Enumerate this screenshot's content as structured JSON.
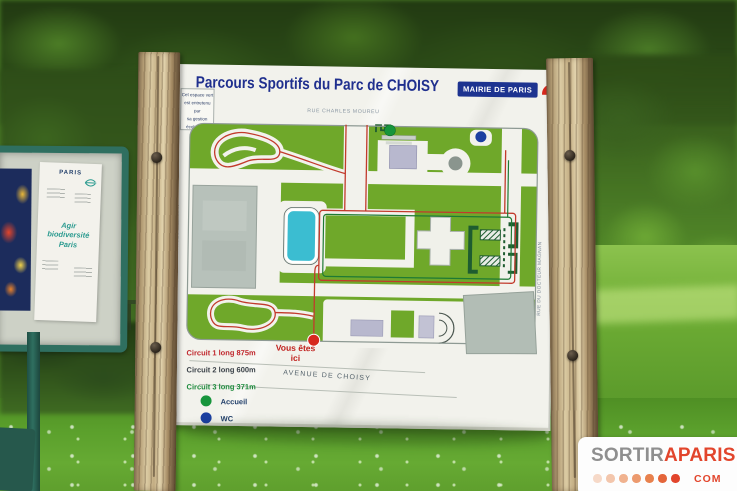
{
  "photo": {
    "subject": "Park sports-circuit information sign, Parc de Choisy, Paris"
  },
  "sign": {
    "title": "Parcours Sportifs du Parc de CHOISY",
    "badge": {
      "label": "MAIRIE DE PARIS"
    },
    "eco_label": {
      "line1": "Cet espace vert",
      "line2": "est entretenu par",
      "line3": "sa gestion",
      "line4": "écologique"
    },
    "map": {
      "street_top": "RUE CHARLES MOUREU",
      "street_left": "RUE GEORGES EASTMAN",
      "street_right": "RUE DU DOCTEUR MAGNAN",
      "street_bottom": "AVENUE DE CHOISY",
      "you_are_here": "Vous êtes ici"
    },
    "legend": {
      "circuit1": "Circuit 1 long 875m",
      "circuit2": "Circuit 2 long 600m",
      "circuit3": "Circuit 3 long 371m",
      "accueil": "Accueil",
      "wc": "WC"
    }
  },
  "notice_board": {
    "brand": "PARIS",
    "line1": "Agir",
    "line2": "biodiversité",
    "line3": "Paris"
  },
  "watermark": {
    "part1": "SORTIR",
    "part2": "APARIS",
    "suffix": "COM"
  },
  "colors": {
    "map_green": "#6fa82a",
    "pond_teal": "#3bbdd1",
    "circuit_red": "#c23a2c",
    "circuit_green": "#1e7a34",
    "accueil_green": "#17953c",
    "wc_blue": "#1b3fa0",
    "you_are_here_red": "#d6281e",
    "title_blue": "#1f2f8e",
    "badge_blue": "#1d3390",
    "watermark_red": "#e2452c",
    "board_white": "#f2f2ec"
  }
}
